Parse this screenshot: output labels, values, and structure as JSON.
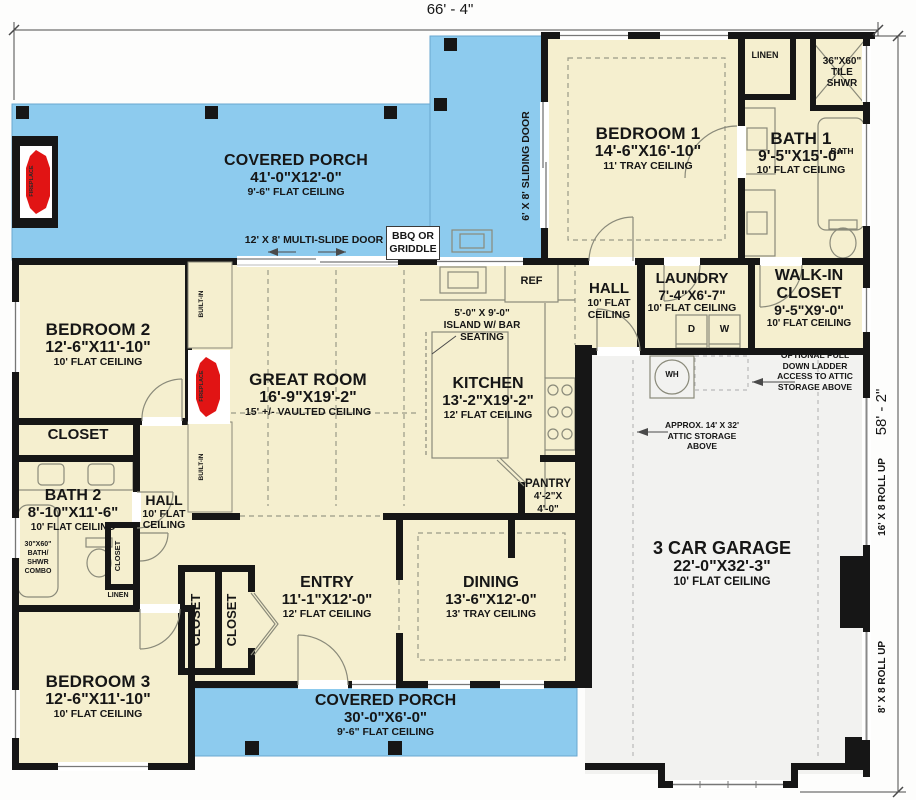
{
  "plan": {
    "title": "First floor plan",
    "dims": {
      "width": "66' - 4\"",
      "height": "58' - 2\""
    },
    "colors": {
      "porch": "#8DCBEE",
      "room": "#F5EFCF",
      "garage": "#F2F2F0",
      "wall": "#161616",
      "fireplace": "#E11414"
    },
    "rooms": {
      "porch_top": {
        "name": "COVERED PORCH",
        "size": "41'-0\"X12'-0\"",
        "ceiling": "9'-6\" FLAT CEILING"
      },
      "porch_bottom": {
        "name": "COVERED PORCH",
        "size": "30'-0\"X6'-0\"",
        "ceiling": "9'-6\" FLAT CEILING"
      },
      "bedroom1": {
        "name": "BEDROOM 1",
        "size": "14'-6\"X16'-10\"",
        "ceiling": "11' TRAY CEILING"
      },
      "bath1": {
        "name": "BATH 1",
        "size": "9'-5\"X15'-0\"",
        "ceiling": "10' FLAT CEILING"
      },
      "hall_top": {
        "name": "HALL",
        "l2": "10' FLAT",
        "l3": "CEILING"
      },
      "laundry": {
        "name": "LAUNDRY",
        "size": "7'-4\"X6'-7\"",
        "ceiling": "10' FLAT CEILING"
      },
      "walk_in": {
        "l1": "WALK-IN",
        "l2": "CLOSET",
        "size": "9'-5\"X9'-0\"",
        "ceiling": "10' FLAT CEILING"
      },
      "bedroom2": {
        "name": "BEDROOM 2",
        "size": "12'-6\"X11'-10\"",
        "ceiling": "10' FLAT CEILING"
      },
      "great_room": {
        "name": "GREAT ROOM",
        "size": "16'-9\"X19'-2\"",
        "ceiling": "15' +/- VAULTED CEILING"
      },
      "kitchen": {
        "name": "KITCHEN",
        "size": "13'-2\"X19'-2\"",
        "ceiling": "12' FLAT CEILING"
      },
      "bath2": {
        "name": "BATH 2",
        "size": "8'-10\"X11'-6\"",
        "ceiling": "10' FLAT CEILING"
      },
      "hall_left": {
        "name": "HALL",
        "l2": "10' FLAT",
        "l3": "CEILING"
      },
      "bedroom3": {
        "name": "BEDROOM 3",
        "size": "12'-6\"X11'-10\"",
        "ceiling": "10' FLAT CEILING"
      },
      "entry": {
        "name": "ENTRY",
        "size": "11'-1\"X12'-0\"",
        "ceiling": "12' FLAT CEILING"
      },
      "dining": {
        "name": "DINING",
        "size": "13'-6\"X12'-0\"",
        "ceiling": "13' TRAY CEILING"
      },
      "pantry": {
        "name": "PANTRY",
        "l2": "4'-2\"X",
        "l3": "4'-0\""
      },
      "garage": {
        "name": "3 CAR GARAGE",
        "size": "22'-0\"X32'-3\"",
        "ceiling": "10' FLAT CEILING"
      }
    },
    "labels": {
      "fireplace": "FIREPLACE",
      "multi_slide_door": "12' X 8' MULTI-SLIDE DOOR",
      "sliding_door": "6' X 8' SLIDING DOOR",
      "bbq1": "BBQ OR",
      "bbq2": "GRIDDLE",
      "linen": "LINEN",
      "tile_shwr1": "36\"X60\"",
      "tile_shwr2": "TILE",
      "tile_shwr3": "SHWR",
      "bath_fixture": "BATH",
      "dryer": "D",
      "washer": "W",
      "closet": "CLOSET",
      "built_in": "BUILT-IN",
      "ref": "REF",
      "wh": "WH",
      "island1": "5'-0\" X 9'-0\"",
      "island2": "ISLAND W/ BAR",
      "island3": "SEATING",
      "combo1": "30\"X60\"",
      "combo2": "BATH/",
      "combo3": "SHWR",
      "combo4": "COMBO",
      "ladder1": "OPTIONAL PULL",
      "ladder2": "DOWN LADDER",
      "ladder3": "ACCESS TO ATTIC",
      "ladder4": "STORAGE ABOVE",
      "attic1": "APPROX. 14' X 32'",
      "attic2": "ATTIC STORAGE",
      "attic3": "ABOVE",
      "roll_up_16": "16' X 8 ROLL UP",
      "roll_up_8": "8' X 8 ROLL UP"
    }
  }
}
